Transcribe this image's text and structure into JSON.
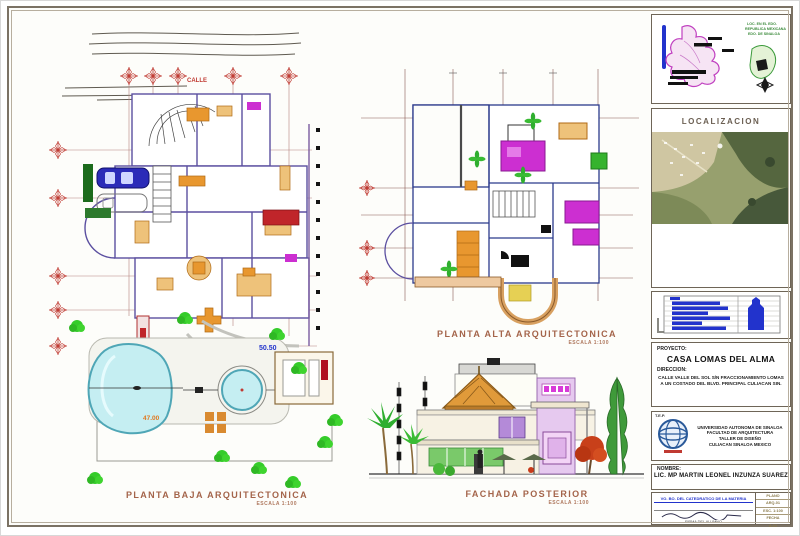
{
  "sheet": {
    "titles": {
      "planta_baja": "PLANTA BAJA ARQUITECTONICA",
      "planta_baja_scale": "ESCALA 1:100",
      "planta_alta": "PLANTA ALTA ARQUITECTONICA",
      "planta_alta_scale": "ESCALA 1:100",
      "fachada": "FACHADA POSTERIOR",
      "fachada_scale": "ESCALA 1:100"
    },
    "plan_labels": {
      "street": "CALLE",
      "pool_level": "47.00",
      "terrace_level": "50.50"
    },
    "colors": {
      "border": "#7b7264",
      "title_text": "#a4644a",
      "grid_red": "#c03a32",
      "wall_purple": "#5b4fa0",
      "wall_navy": "#2b3a8c",
      "furniture_orange": "#e8972f",
      "accent_magenta": "#cc2fd1",
      "pool_cyan": "#c5eef2",
      "tree_green": "#35cc2a",
      "croquis_blue": "#2233cc"
    }
  },
  "title_block": {
    "map_title_lines": [
      "LOC. EN EL EDO.",
      "REPUBLICA MEXICANA",
      "EDO. DE SINALOA"
    ],
    "localizacion_label": "LOCALIZACION",
    "project_label": "PROYECTO:",
    "project_name": "CASA LOMAS DEL ALMA",
    "address_label": "DIRECCION:",
    "address_line1": "CALLE VALLE DEL SOL S/N FRACCIONAMIENTO LOMAS",
    "address_line2": "A UN COSTADO DEL BLVD. PRINCIPAL CULIACAN SIN.",
    "school_label": "T.E.P.",
    "school_lines": [
      "UNIVERSIDAD AUTONOMA DE SINALOA",
      "FACULTAD DE ARQUITECTURA",
      "TALLER DE DISEÑO",
      "CULIACAN SINALOA MEXICO"
    ],
    "name_label": "NOMBRE:",
    "name_value": "LIC. MP MARTIN LEONEL INZUNZA SUAREZ",
    "sign_header": "VO. BO. DEL CATEDRATICO DE LA MATERIA",
    "sign_caption": "FIRMA DEL ALUMNO",
    "stamp_lines": [
      "PLANO",
      "ARQ-01",
      "ESC. 1:100",
      "FECHA",
      "A-01"
    ]
  }
}
